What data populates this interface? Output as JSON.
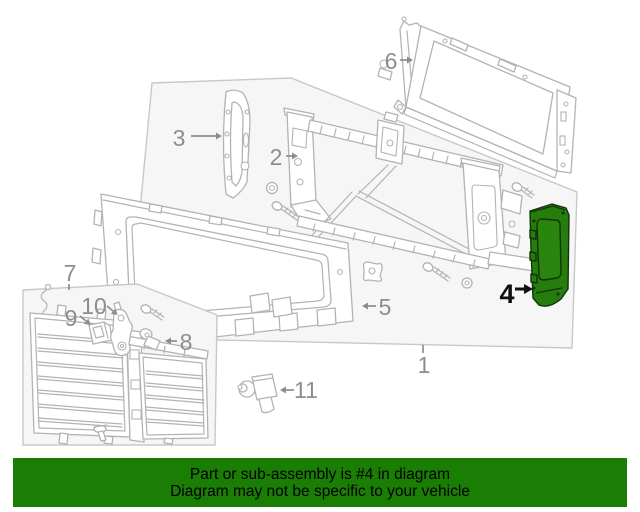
{
  "diagram": {
    "highlighted_part": "4",
    "colors": {
      "highlight_fill": "#247d0d",
      "highlight_window_fill": "#2a850f",
      "highlight_stroke": "#14330a",
      "line_art": "#b3b3b3",
      "box_fill": "#f6f6f6",
      "box_stroke": "#c8c8c8",
      "label_gray": "#8d8d8d",
      "label_black": "#111111"
    },
    "callouts": [
      {
        "num": "1"
      },
      {
        "num": "2"
      },
      {
        "num": "3"
      },
      {
        "num": "4"
      },
      {
        "num": "5"
      },
      {
        "num": "6"
      },
      {
        "num": "7"
      },
      {
        "num": "8"
      },
      {
        "num": "9"
      },
      {
        "num": "10"
      },
      {
        "num": "11"
      }
    ]
  },
  "banner": {
    "line1": "Part or sub-assembly is #4 in diagram",
    "line2": "Diagram may not be specific to your vehicle",
    "bg": "#1a7e05",
    "text_color": "#000000"
  }
}
